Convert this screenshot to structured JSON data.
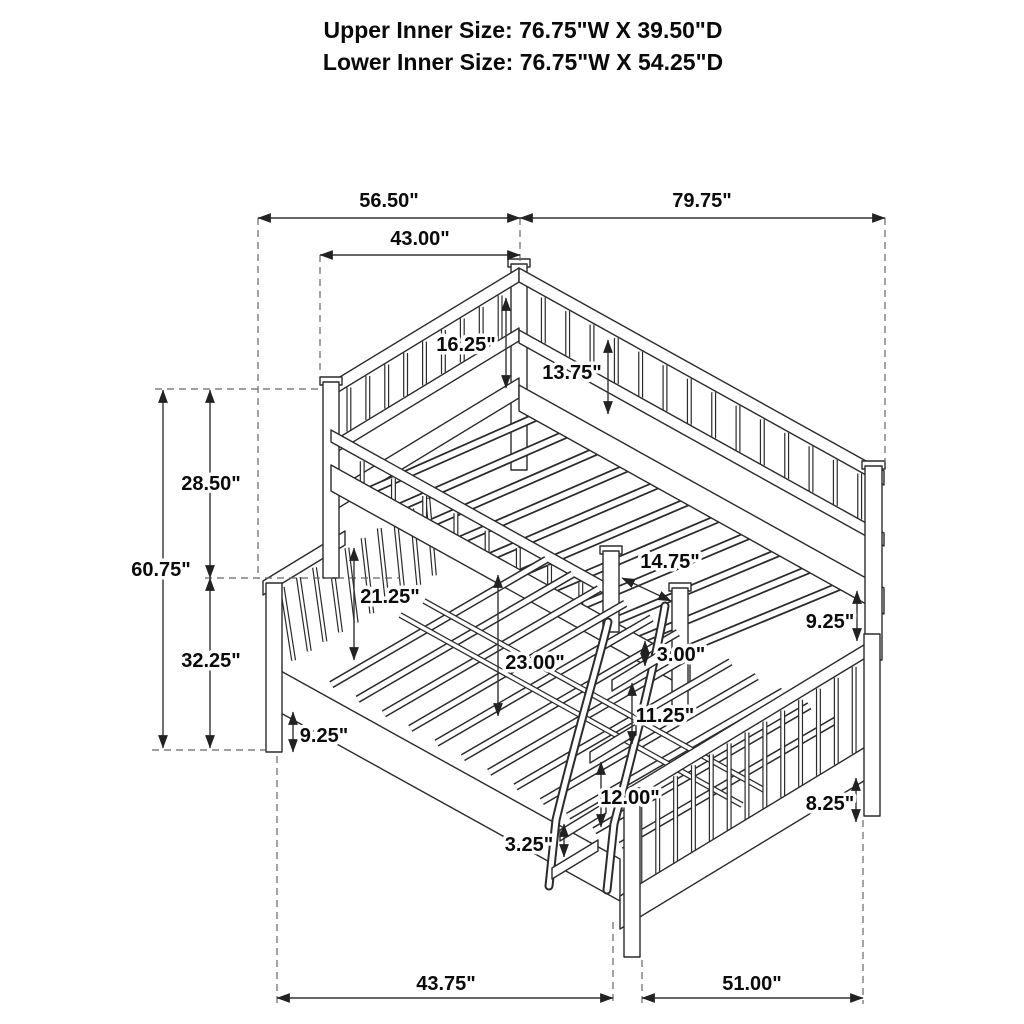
{
  "title": {
    "line1": "Upper Inner Size: 76.75\"W X 39.50\"D",
    "line2": "Lower Inner Size: 76.75\"W X 54.25\"D"
  },
  "dimensions": {
    "upper_width_span": "56.50\"",
    "lower_width_span": "79.75\"",
    "upper_depth": "43.00\"",
    "upper_headboard_height": "16.25\"",
    "upper_guardrail_height": "13.75\"",
    "upper_section_height": "28.50\"",
    "overall_height": "60.75\"",
    "lower_headboard_height": "32.25\"",
    "lower_rail_floor_gap": "9.25\"",
    "lower_guard_height": "21.25\"",
    "bunk_clearance": "23.00\"",
    "ladder_opening_width": "14.75\"",
    "ladder_top_step_gap": "3.00\"",
    "side_rail_gap": "9.25\"",
    "ladder_step_gap_upper": "11.25\"",
    "ladder_step_gap_lower": "12.00\"",
    "side_rail_thickness": "3.25\"",
    "footboard_floor_gap": "8.25\"",
    "floor_span_left": "43.75\"",
    "floor_span_right": "51.00\""
  }
}
